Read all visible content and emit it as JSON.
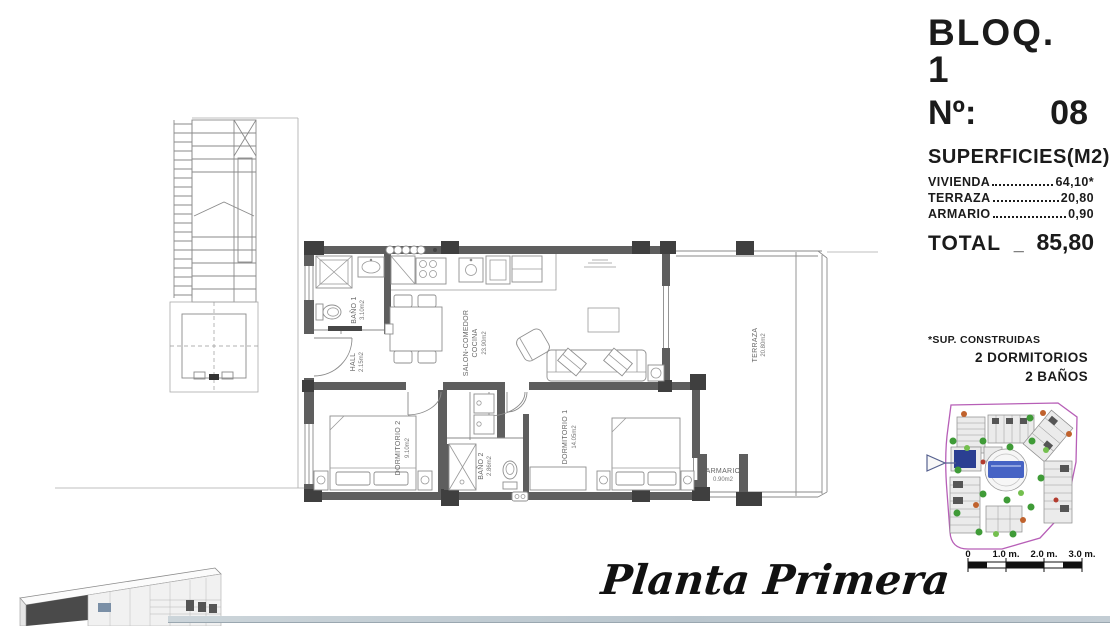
{
  "header": {
    "block": "BLOQ. 1",
    "unit_label": "Nº:",
    "unit_number": "08"
  },
  "superficies": {
    "title": "SUPERFICIES(M2)",
    "rows": [
      {
        "label": "VIVIENDA",
        "value": "64,10*"
      },
      {
        "label": "TERRAZA",
        "value": "20,80"
      },
      {
        "label": "ARMARIO",
        "value": "0,90"
      }
    ],
    "total_label": "TOTAL",
    "total_separator": "_",
    "total_value": "85,80"
  },
  "notes": {
    "footnote": "*SUP. CONSTRUIDAS",
    "line1": "2 DORMITORIOS",
    "line2": "2 BAÑOS"
  },
  "plan_title": "Planta Primera",
  "rooms": {
    "bano1": {
      "name": "BAÑO 1",
      "area": "3.10m2"
    },
    "hall": {
      "name": "HALL",
      "area": "2.15m2"
    },
    "salon": {
      "name": "SALON-COMEDOR",
      "name2": "COCINA",
      "area": "23.90m2"
    },
    "terraza": {
      "name": "TERRAZA",
      "area": "20.80m2"
    },
    "dormitorio2": {
      "name": "DORMITORIO 2",
      "area": "9.10m2"
    },
    "bano2": {
      "name": "BAÑO 2",
      "area": "2.86m2"
    },
    "dormitorio1": {
      "name": "DORMITORIO 1",
      "area": "14.05m2"
    },
    "armario": {
      "name": "ARMARIO",
      "area": "0.90m2"
    }
  },
  "scale_bar": {
    "labels": [
      "0",
      "1.0 m.",
      "2.0 m.",
      "3.0 m."
    ]
  },
  "colors": {
    "wall": "#5e5e5e",
    "column": "#3f3f3f",
    "map_boundary": "#b75fb7",
    "unit_highlight": "#2b3f92",
    "pool": "#4663c4",
    "tree_green": "#3f9b37",
    "tree_light_green": "#74bf4e",
    "tree_orange": "#c0622d"
  }
}
